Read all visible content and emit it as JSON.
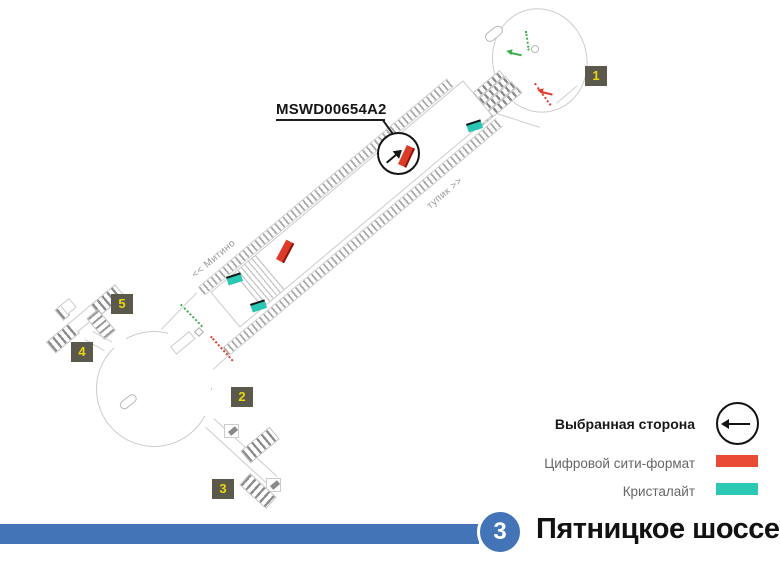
{
  "station": {
    "line_badge": "3",
    "name": "Пятницкое шоссе",
    "line_color": "#4374B7"
  },
  "selected_surface": {
    "id": "MSWD00654A2"
  },
  "platform_labels": {
    "to_mitino": "<< Митино",
    "dead_end": "тупик >>"
  },
  "exits": {
    "n1": "1",
    "n2": "2",
    "n3": "3",
    "n4": "4",
    "n5": "5"
  },
  "legend": {
    "selected_side_label": "Выбранная сторона",
    "items": [
      {
        "label": "Цифровой сити-формат",
        "color": "#EA4B35"
      },
      {
        "label": "Кристалайт",
        "color": "#2BC8B4"
      }
    ]
  },
  "marker_colors": {
    "digital": "#DC3B28",
    "crystalite": "#2AC7B2"
  }
}
